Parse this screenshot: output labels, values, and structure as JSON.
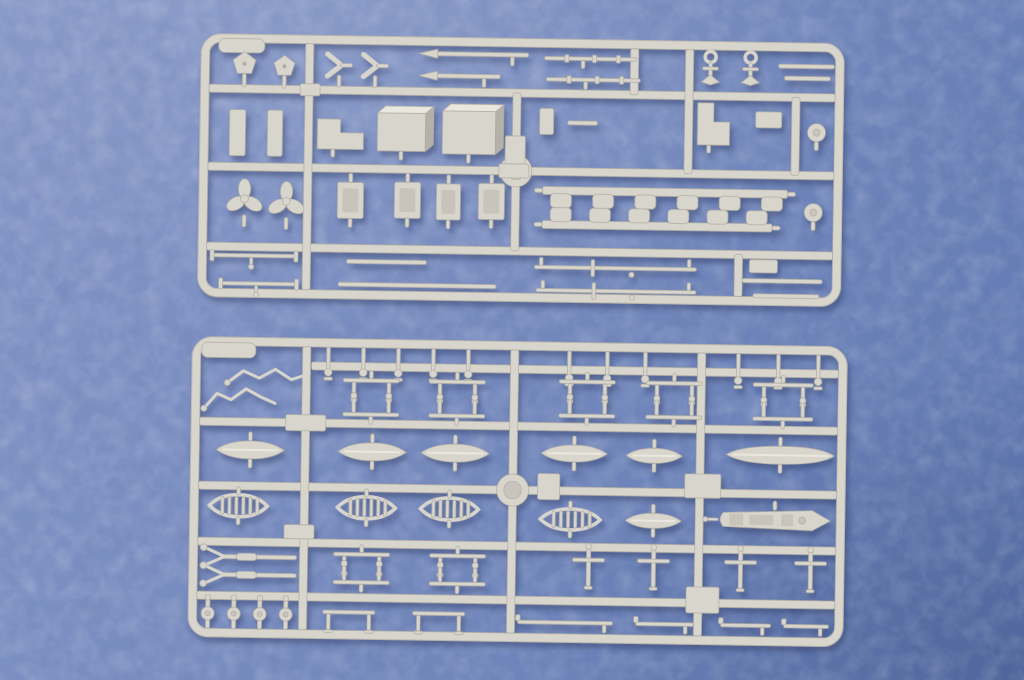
{
  "scene": {
    "description": "Overhead product photo of two light-grey injection-moulded plastic sprues (part frames) from a ship model kit, lying on a blue leatherette background",
    "subject": "model kit sprues holding small ship fittings: deckhouse boxes, propellers, anchors, oars, masts and yards, davits, stanchions, winches and ship's boats",
    "sprue_count": 2
  },
  "colors": {
    "background_light": "#8496c7",
    "background_mid": "#7589bd",
    "background_dark": "#5f78b2",
    "plastic": "#d8d5cc",
    "plastic_light": "#eae7df",
    "plastic_dark": "#b0aca3",
    "plastic_inner": "#c8c4bb",
    "plastic_side": "#b5b1a8",
    "shadow": "#2c3a66"
  },
  "part_labels": {
    "rect": "moulding-block",
    "rod": "rod",
    "pentagon": "hawse-fitting",
    "vbracket": "v-bracket",
    "spear": "oar",
    "fitrod": "fitted-yard",
    "anchor": "anchor",
    "propeller": "propeller",
    "box3d": "deckhouse-box",
    "lbracket": "angle-bracket",
    "hbox": "gun-mount",
    "notchstrip": "notched-bulkhead-strip",
    "crossyard": "yardarm",
    "crossrod": "yardarm",
    "hookdisc": "pulley-disc",
    "wire": "railing-wire",
    "pinrow": "stanchion-row",
    "davitpair": "davit-pair",
    "hull": "boat-hull",
    "openboat": "open-boat",
    "launch": "motor-launch",
    "yrod": "forked-boom",
    "cross": "cross-davit",
    "winch": "winch",
    "goalpost": "davit-frame",
    "yardrod": "yard"
  },
  "sprues": [
    {
      "id": "sprue-top",
      "x": 201,
      "y": 33,
      "rot": 0.9,
      "w": 644,
      "h": 264,
      "bar": 8,
      "frame": 9,
      "radius": 16,
      "tab": {
        "x": 18,
        "y": 5,
        "w": 46,
        "h": 14
      },
      "hub": {
        "x": 317,
        "y": 133,
        "r": 16
      },
      "runners": {
        "h": [
          {
            "y": 55,
            "x1": 9,
            "x2": 635
          },
          {
            "y": 133,
            "x1": 9,
            "x2": 635
          },
          {
            "y": 213,
            "x1": 9,
            "x2": 635
          }
        ],
        "v": [
          {
            "x": 109,
            "y1": 9,
            "y2": 255
          },
          {
            "x": 317,
            "y1": 55,
            "y2": 213
          },
          {
            "x": 434,
            "y1": 9,
            "y2": 55
          },
          {
            "x": 489,
            "y1": 9,
            "y2": 133
          },
          {
            "x": 541,
            "y1": 213,
            "y2": 255
          },
          {
            "x": 596,
            "y1": 55,
            "y2": 133
          }
        ]
      },
      "parts": [
        {
          "t": "pentagon",
          "cx": 44,
          "cy": 30,
          "r": 12
        },
        {
          "t": "pentagon",
          "cx": 84,
          "cy": 32,
          "r": 11
        },
        {
          "t": "vbracket",
          "cx": 138,
          "cy": 30
        },
        {
          "t": "vbracket",
          "cx": 174,
          "cy": 30
        },
        {
          "t": "spear",
          "x": 222,
          "y": 15,
          "len": 106
        },
        {
          "t": "spear",
          "x": 222,
          "y": 37,
          "len": 78
        },
        {
          "t": "fitrod",
          "x": 344,
          "y": 18,
          "len": 92
        },
        {
          "t": "fitrod",
          "x": 346,
          "y": 39,
          "len": 94
        },
        {
          "t": "anchor",
          "cx": 510,
          "cy": 25
        },
        {
          "t": "anchor",
          "cx": 550,
          "cy": 25
        },
        {
          "t": "rod",
          "x": 578,
          "y": 22,
          "len": 56,
          "h": 4
        },
        {
          "t": "rod",
          "x": 584,
          "y": 34,
          "len": 46,
          "h": 4
        },
        {
          "t": "rect",
          "x": 100,
          "y": 49,
          "w": 20,
          "h": 12
        },
        {
          "t": "rect",
          "x": 30,
          "y": 76,
          "w": 16,
          "h": 46
        },
        {
          "t": "rect",
          "x": 68,
          "y": 76,
          "w": 15,
          "h": 46
        },
        {
          "t": "lbracket",
          "x": 118,
          "y": 84,
          "w": 46,
          "h": 30
        },
        {
          "t": "box3d",
          "x": 178,
          "y": 70,
          "w": 56,
          "h": 45
        },
        {
          "t": "box3d",
          "x": 243,
          "y": 67,
          "w": 61,
          "h": 50
        },
        {
          "t": "rect",
          "x": 340,
          "y": 70,
          "w": 14,
          "h": 26
        },
        {
          "t": "rod",
          "x": 368,
          "y": 82,
          "len": 30,
          "h": 4
        },
        {
          "t": "lbracket",
          "x": 498,
          "y": 62,
          "w": 32,
          "h": 42
        },
        {
          "t": "rect",
          "x": 556,
          "y": 70,
          "w": 26,
          "h": 16
        },
        {
          "t": "hookdisc",
          "cx": 617,
          "cy": 90
        },
        {
          "t": "rect",
          "x": 306,
          "y": 98,
          "w": 20,
          "h": 28
        },
        {
          "t": "rect",
          "x": 300,
          "y": 126,
          "w": 30,
          "h": 14
        },
        {
          "t": "propeller",
          "cx": 46,
          "cy": 165,
          "r": 18
        },
        {
          "t": "propeller",
          "cx": 88,
          "cy": 167,
          "r": 18
        },
        {
          "t": "hbox",
          "x": 139,
          "y": 147,
          "w": 26,
          "h": 36
        },
        {
          "t": "hbox",
          "x": 196,
          "y": 146,
          "w": 26,
          "h": 36
        },
        {
          "t": "hbox",
          "x": 238,
          "y": 147,
          "w": 24,
          "h": 36
        },
        {
          "t": "hbox",
          "x": 280,
          "y": 146,
          "w": 26,
          "h": 36
        },
        {
          "t": "notchstrip",
          "x": 344,
          "y": 148,
          "len": 245,
          "teeth": 6,
          "side": -1
        },
        {
          "t": "notchstrip",
          "x": 344,
          "y": 182,
          "len": 230,
          "teeth": 6,
          "side": 1
        },
        {
          "t": "hookdisc",
          "cx": 615,
          "cy": 170
        },
        {
          "t": "crossyard",
          "x": 14,
          "y": 220,
          "len": 85
        },
        {
          "t": "crossyard",
          "x": 23,
          "y": 248,
          "len": 77
        },
        {
          "t": "rod",
          "x": 149,
          "y": 224,
          "len": 80,
          "h": 4
        },
        {
          "t": "rod",
          "x": 141,
          "y": 247,
          "len": 158,
          "h": 4
        },
        {
          "t": "crossrod",
          "x": 337,
          "y": 227,
          "len": 162
        },
        {
          "t": "crossrod",
          "x": 339,
          "y": 250,
          "len": 160
        },
        {
          "t": "rect",
          "x": 552,
          "y": 218,
          "w": 28,
          "h": 13
        },
        {
          "t": "rod",
          "x": 545,
          "y": 237,
          "len": 80,
          "h": 4
        },
        {
          "t": "rod",
          "x": 556,
          "y": 252,
          "len": 66,
          "h": 4
        }
      ]
    },
    {
      "id": "sprue-bottom",
      "x": 192,
      "y": 336,
      "rot": 0.9,
      "w": 656,
      "h": 301,
      "bar": 8,
      "frame": 9,
      "radius": 16,
      "tab": {
        "x": 10,
        "y": 6,
        "w": 54,
        "h": 15
      },
      "hub": {
        "x": 323,
        "y": 149,
        "r": 16
      },
      "runners": {
        "h": [
          {
            "y": 28,
            "x1": 120,
            "x2": 647
          },
          {
            "y": 85,
            "x1": 9,
            "x2": 647
          },
          {
            "y": 149,
            "x1": 9,
            "x2": 647
          },
          {
            "y": 205,
            "x1": 9,
            "x2": 647
          },
          {
            "y": 259,
            "x1": 9,
            "x2": 647
          }
        ],
        "v": [
          {
            "x": 115,
            "y1": 9,
            "y2": 292
          },
          {
            "x": 323,
            "y1": 9,
            "y2": 292
          },
          {
            "x": 510,
            "y1": 9,
            "y2": 292
          }
        ]
      },
      "parts": [
        {
          "t": "wire",
          "pts": [
            [
              36,
              46
            ],
            [
              52,
              34
            ],
            [
              68,
              41
            ],
            [
              84,
              32
            ],
            [
              100,
              42
            ],
            [
              112,
              38
            ]
          ]
        },
        {
          "t": "wire",
          "pts": [
            [
              13,
              72
            ],
            [
              26,
              57
            ],
            [
              40,
              63
            ],
            [
              55,
              52
            ],
            [
              70,
              60
            ],
            [
              84,
              66
            ]
          ]
        },
        {
          "t": "pinrow",
          "x": 135,
          "y": 9,
          "n": 5,
          "gap": 35,
          "len": 22
        },
        {
          "t": "pinrow",
          "x": 376,
          "y": 9,
          "n": 3,
          "gap": 38,
          "len": 24
        },
        {
          "t": "pinrow",
          "x": 545,
          "y": 9,
          "n": 3,
          "gap": 40,
          "len": 24
        },
        {
          "t": "davitpair",
          "x": 152,
          "y": 40,
          "w": 56
        },
        {
          "t": "davitpair",
          "x": 238,
          "y": 40,
          "w": 56
        },
        {
          "t": "davitpair",
          "x": 368,
          "y": 38,
          "w": 56
        },
        {
          "t": "davitpair",
          "x": 455,
          "y": 38,
          "w": 56
        },
        {
          "t": "davitpair",
          "x": 562,
          "y": 38,
          "w": 60
        },
        {
          "t": "davitpair",
          "x": 152,
          "y": 74,
          "w": 56,
          "flip": 1
        },
        {
          "t": "davitpair",
          "x": 238,
          "y": 74,
          "w": 56,
          "flip": 1
        },
        {
          "t": "davitpair",
          "x": 368,
          "y": 72,
          "w": 56,
          "flip": 1
        },
        {
          "t": "davitpair",
          "x": 455,
          "y": 72,
          "w": 56,
          "flip": 1
        },
        {
          "t": "davitpair",
          "x": 562,
          "y": 72,
          "w": 60,
          "flip": 1
        },
        {
          "t": "rect",
          "x": 95,
          "y": 77,
          "w": 40,
          "h": 16
        },
        {
          "t": "hull",
          "x": 26,
          "y": 104,
          "w": 68,
          "h": 18
        },
        {
          "t": "hull",
          "x": 148,
          "y": 104,
          "w": 68,
          "h": 18
        },
        {
          "t": "hull",
          "x": 231,
          "y": 104,
          "w": 68,
          "h": 18
        },
        {
          "t": "hull",
          "x": 351,
          "y": 103,
          "w": 66,
          "h": 17
        },
        {
          "t": "hull",
          "x": 436,
          "y": 105,
          "w": 56,
          "h": 15
        },
        {
          "t": "hull",
          "x": 536,
          "y": 101,
          "w": 108,
          "h": 18,
          "pointed": 1
        },
        {
          "t": "rect",
          "x": 348,
          "y": 132,
          "w": 22,
          "h": 26
        },
        {
          "t": "rect",
          "x": 495,
          "y": 130,
          "w": 36,
          "h": 24
        },
        {
          "t": "openboat",
          "x": 20,
          "y": 158,
          "w": 58,
          "h": 22
        },
        {
          "t": "openboat",
          "x": 148,
          "y": 158,
          "w": 58,
          "h": 22
        },
        {
          "t": "openboat",
          "x": 231,
          "y": 158,
          "w": 58,
          "h": 22
        },
        {
          "t": "openboat",
          "x": 351,
          "y": 167,
          "w": 60,
          "h": 21
        },
        {
          "t": "hull",
          "x": 436,
          "y": 170,
          "w": 56,
          "h": 15
        },
        {
          "t": "launch",
          "x": 528,
          "y": 165,
          "w": 115,
          "h": 20
        },
        {
          "t": "rect",
          "x": 95,
          "y": 187,
          "w": 30,
          "h": 14
        },
        {
          "t": "yrod",
          "x": 12,
          "y": 218,
          "len": 96
        },
        {
          "t": "yrod",
          "x": 12,
          "y": 236,
          "len": 96
        },
        {
          "t": "davitpair",
          "x": 145,
          "y": 214,
          "w": 56
        },
        {
          "t": "davitpair",
          "x": 241,
          "y": 214,
          "w": 56
        },
        {
          "t": "davitpair",
          "x": 145,
          "y": 242,
          "w": 56,
          "flip": 1
        },
        {
          "t": "davitpair",
          "x": 241,
          "y": 242,
          "w": 56,
          "flip": 1
        },
        {
          "t": "cross",
          "cx": 400,
          "cy": 224
        },
        {
          "t": "cross",
          "cx": 465,
          "cy": 224
        },
        {
          "t": "cross",
          "cx": 552,
          "cy": 224
        },
        {
          "t": "cross",
          "cx": 622,
          "cy": 224
        },
        {
          "t": "rect",
          "x": 498,
          "y": 243,
          "w": 33,
          "h": 26
        },
        {
          "t": "winch",
          "cx": 20,
          "cy": 277
        },
        {
          "t": "winch",
          "cx": 46,
          "cy": 277
        },
        {
          "t": "winch",
          "cx": 72,
          "cy": 277
        },
        {
          "t": "winch",
          "cx": 98,
          "cy": 277
        },
        {
          "t": "goalpost",
          "x": 135,
          "y": 272,
          "w": 52
        },
        {
          "t": "goalpost",
          "x": 225,
          "y": 272,
          "w": 52
        },
        {
          "t": "yardrod",
          "x": 330,
          "y": 279,
          "len": 95
        },
        {
          "t": "yardrod",
          "x": 448,
          "y": 279,
          "len": 58
        },
        {
          "t": "yardrod",
          "x": 533,
          "y": 279,
          "len": 50
        },
        {
          "t": "yardrod",
          "x": 596,
          "y": 279,
          "len": 45
        }
      ]
    }
  ]
}
